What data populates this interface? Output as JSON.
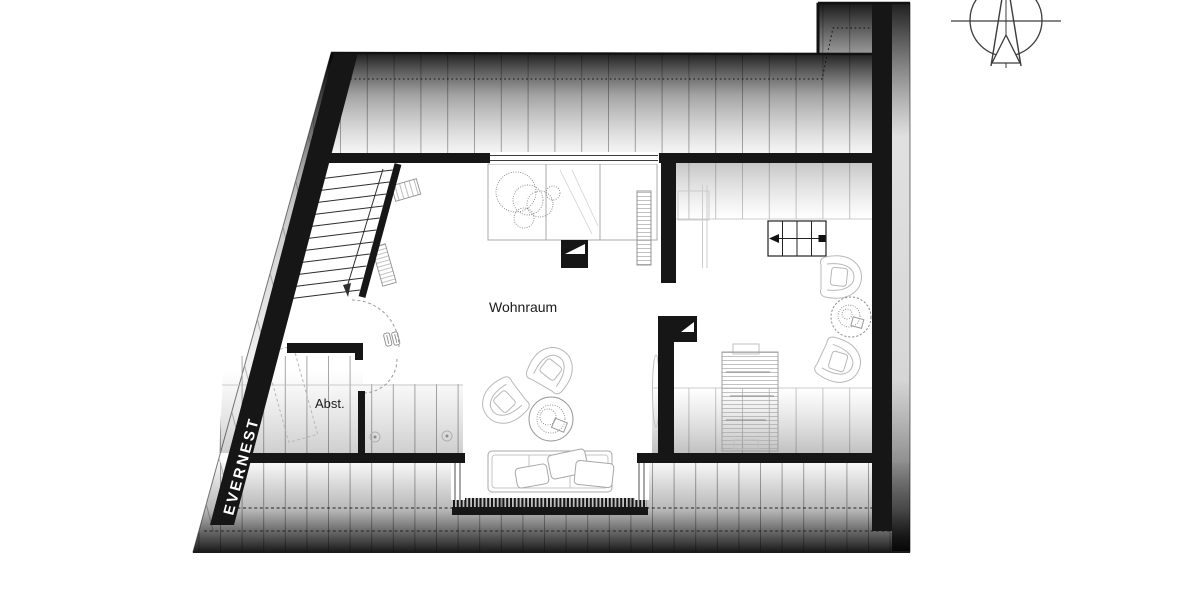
{
  "canvas": {
    "width": 1200,
    "height": 600,
    "background": "#ffffff"
  },
  "floor_plan": {
    "watermark": {
      "text": "EVERNEST",
      "color": "#ffffff"
    },
    "labels": {
      "living_room": "Wohnraum",
      "storage": "Abst."
    },
    "rooms": [
      {
        "id": "wohnraum",
        "label": "Wohnraum"
      },
      {
        "id": "abstellraum",
        "label": "Abst."
      }
    ],
    "colors": {
      "wall": "#161616",
      "roof_hatch_line": "#9e9e9e",
      "furniture_line": "#b0b0b0",
      "label_text": "#1b1b1b"
    },
    "compass": {
      "type": "north-arrow"
    }
  }
}
